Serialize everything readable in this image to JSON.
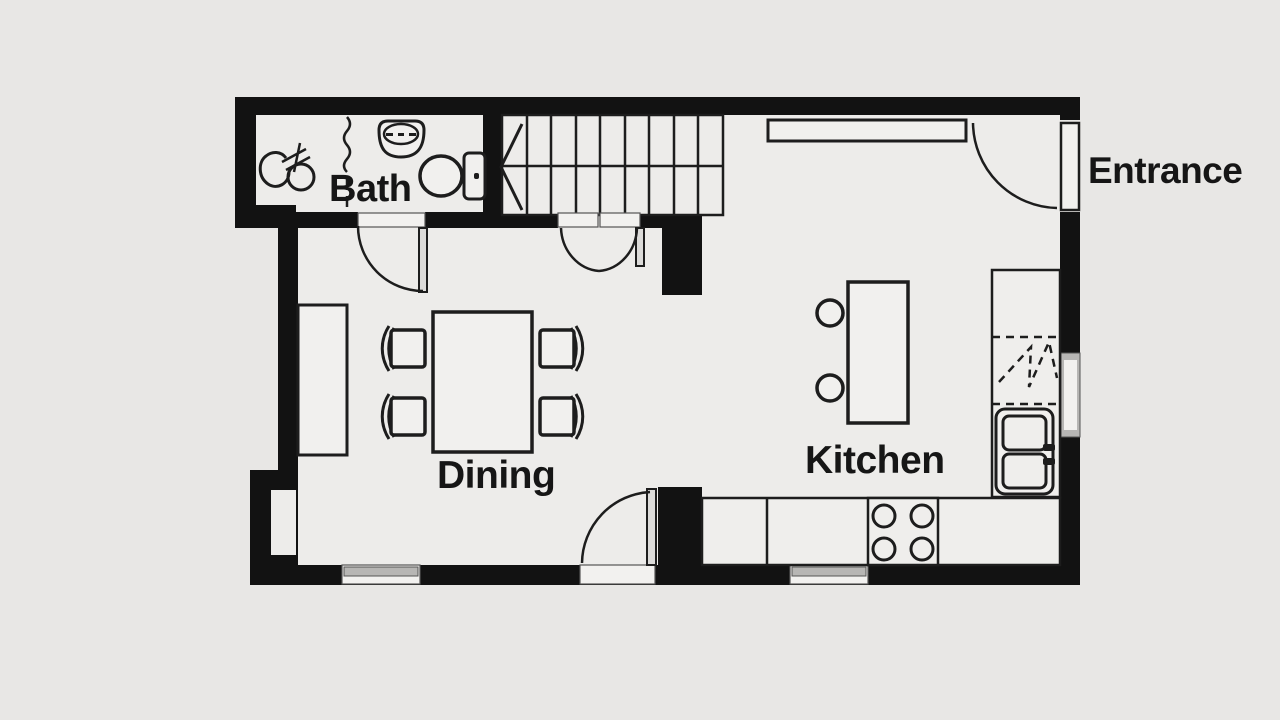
{
  "labels": {
    "bath": "Bath",
    "dining": "Dining",
    "kitchen": "Kitchen",
    "entrance": "Entrance"
  },
  "colors": {
    "bg": "#e8e7e5",
    "floor": "#edecea",
    "wall": "#121212",
    "line": "#1d1d1d",
    "furniture": "#f1f0ee",
    "counter": "#efeeec",
    "leaf": "#dcdbd9",
    "glass": "#b7b6b4",
    "opening": "#f2f1ef",
    "text": "#161616"
  }
}
